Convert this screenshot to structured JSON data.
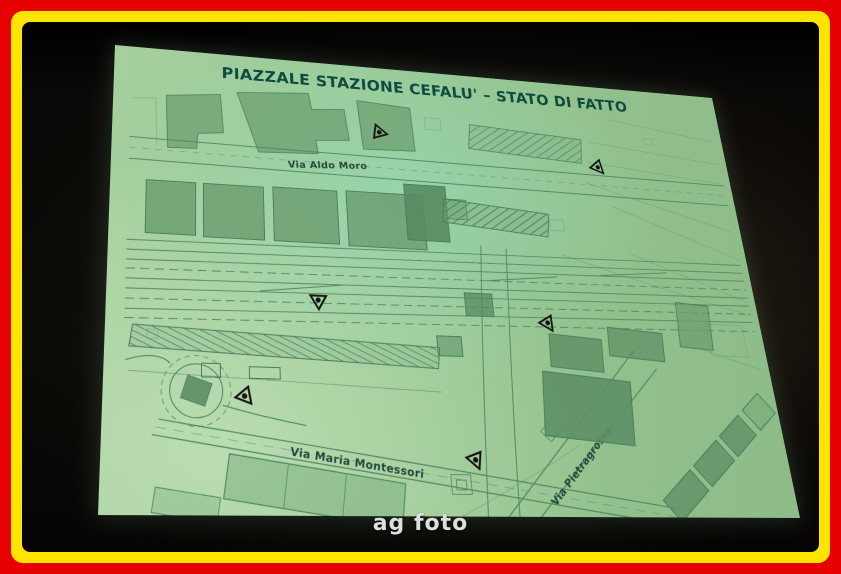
{
  "frame": {
    "outer_color": "#e60000",
    "inner_color": "#ffe400"
  },
  "photo": {
    "watermark": "ag foto"
  },
  "slide": {
    "title": "PIAZZALE STAZIONE CEFALU' – STATO DI FATTO",
    "background_color": "#9ac793",
    "title_color": "#0e4a3d",
    "line_color": "#4d8865",
    "streets": [
      {
        "name": "Via Aldo Moro"
      },
      {
        "name": "Via Maria Montessori"
      },
      {
        "name": "Via Pietragrossa"
      }
    ],
    "symbols": {
      "viewpoint_marker_count": 6,
      "features": [
        "railway-tracks",
        "buildings",
        "station-platform-hatched",
        "roundabout",
        "roads"
      ]
    }
  }
}
